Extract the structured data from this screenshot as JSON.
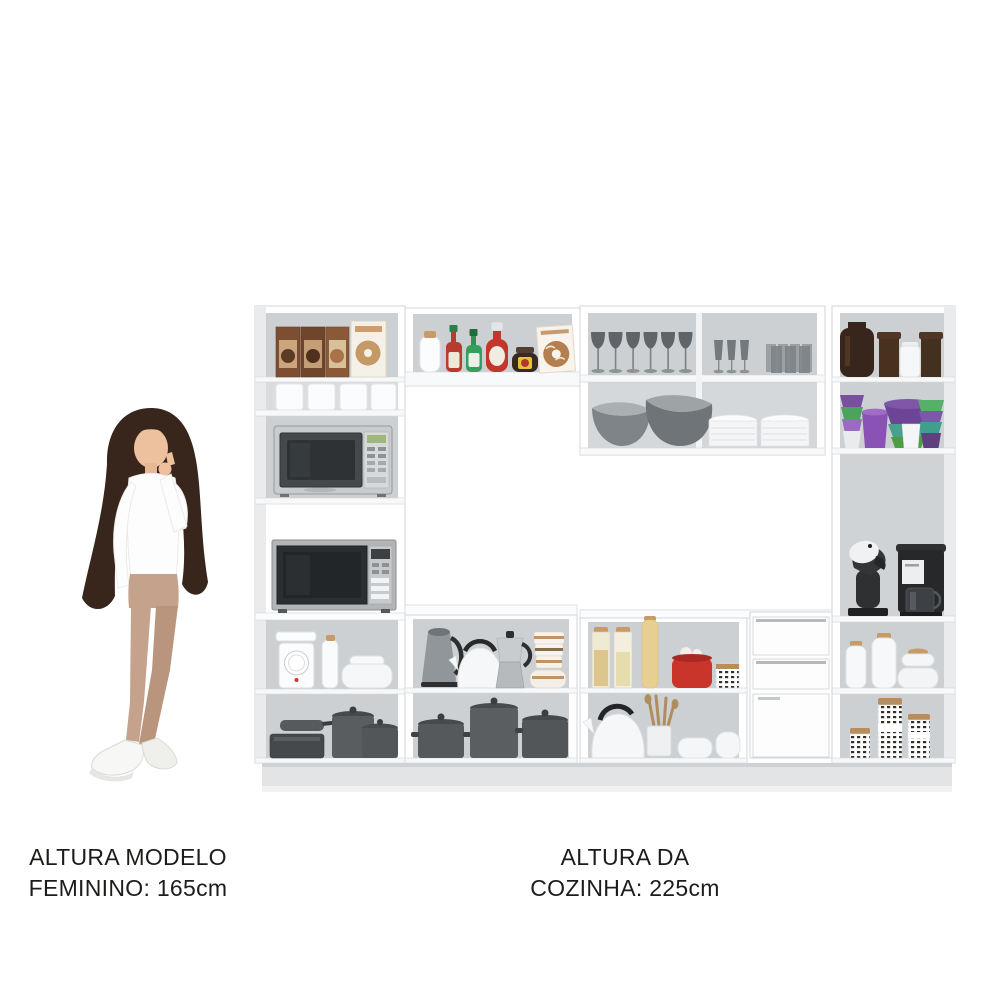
{
  "background": "#ffffff",
  "labels": {
    "model_height": {
      "line1": "ALTURA MODELO",
      "line2": "FEMININO: 165cm"
    },
    "kitchen_height": {
      "line1": "ALTURA DA",
      "line2": "COZINHA: 225cm"
    }
  },
  "figure": {
    "subject": "woman-model-pointing-at-cabinet",
    "hair_color": "#38261d",
    "skin_color": "#eec19e",
    "top_color": "#fdfdfd",
    "pants_color": "#c5a28c",
    "shoes_color": "#f7f7f5"
  },
  "cabinet": {
    "frame_color": "#ffffff",
    "interior_color": "#cdd0d2",
    "plinth_color": "#e2e4e6",
    "accent_colors": {
      "wood_lid": "#c79a66",
      "red_item": "#c2362b",
      "green_bottle": "#35a05c",
      "purple_cup": "#7e57a8",
      "green_cup": "#57b06a",
      "brown_jar": "#38251b",
      "appliance_dark": "#26282a",
      "pot_gray": "#55595b"
    },
    "sections": {
      "left_column": [
        "cereal-boxes",
        "white-canisters-row",
        "silver-microwave",
        "panasonic-microwave",
        "kitchen-scale-bottle-dish",
        "pots-and-pans"
      ],
      "top_shelf": [
        "white-jar",
        "hot-sauce-bottles",
        "ketchup-bottle",
        "spread-jar",
        "cookie-box"
      ],
      "upper_right_cabinet": [
        "six-wine-glasses",
        "three-flutes",
        "tumbler-set",
        "glass-bowls",
        "plate-stacks"
      ],
      "right_column": [
        "brown-glass-jars",
        "colored-plastic-cups-bowls",
        "espresso-machine",
        "drip-coffee-maker",
        "white-canisters-bowls",
        "patterned-storage-jars"
      ],
      "lower_cabinets": [
        "electric-kettle",
        "whistling-kettles",
        "moka-pot",
        "striped-cup-stack",
        "stock-pots",
        "pasta-jars",
        "red-garlic-pot",
        "utensil-holder",
        "white-bowls",
        "two-drawers-one-door-unit"
      ]
    }
  }
}
